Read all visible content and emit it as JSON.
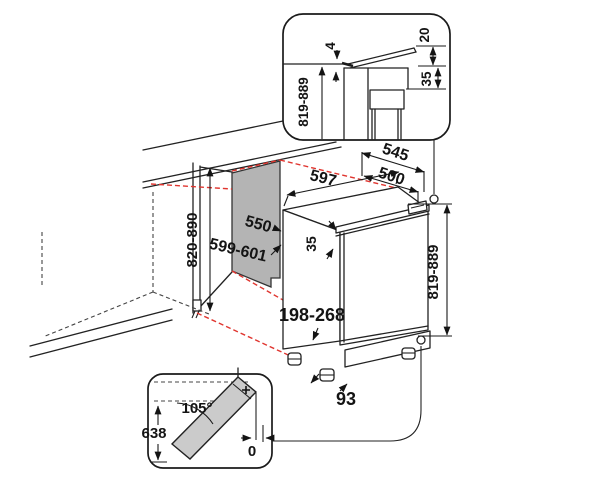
{
  "diagram_title": "Built-under appliance installation dimensions",
  "colors": {
    "line": "#222222",
    "projection_red": "#e0352f",
    "niche_panel_gray": "#b4b4b4",
    "door_gray": "#cbcbcb",
    "background": "#ffffff"
  },
  "labels": {
    "main": {
      "width": "597",
      "depth_total": "545",
      "depth_top": "500",
      "trim": "35",
      "height": "819-889",
      "plinth": "198-268",
      "foot": "93"
    },
    "niche": {
      "depth": "550",
      "width": "599-601",
      "height": "820-890"
    },
    "top_detail": {
      "gap": "4",
      "flap": "20",
      "clearance": "35",
      "height": "819-889"
    },
    "door_detail": {
      "angle": "105°",
      "height": "638",
      "gap": "0"
    }
  }
}
